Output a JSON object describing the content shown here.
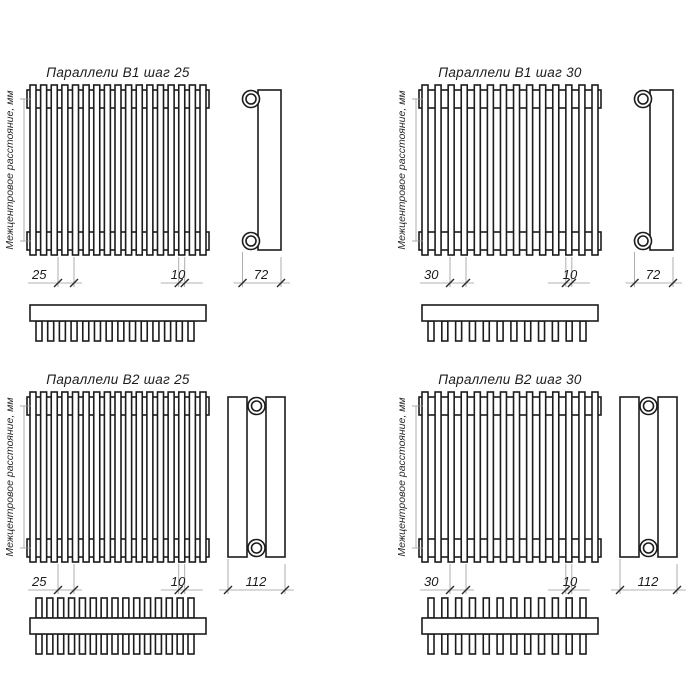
{
  "drawing": {
    "background": "#ffffff",
    "line_color": "#1c1c1c",
    "dim_line_color": "#9a9a9a",
    "axis_label": "Межцентровое расстояние, мм",
    "diagrams": [
      {
        "id": "b1-step25",
        "title": "Параллели В1 шаг 25",
        "variant": "B1",
        "front_tube_count": 17,
        "top_teeth_count": 14,
        "dim_step": "25",
        "dim_tube_width": "10",
        "dim_depth": "72"
      },
      {
        "id": "b1-step30",
        "title": "Параллели В1 шаг 30",
        "variant": "B1",
        "front_tube_count": 14,
        "top_teeth_count": 12,
        "dim_step": "30",
        "dim_tube_width": "10",
        "dim_depth": "72"
      },
      {
        "id": "b2-step25",
        "title": "Параллели В2 шаг 25",
        "variant": "B2",
        "front_tube_count": 17,
        "top_teeth_count": 15,
        "dim_step": "25",
        "dim_tube_width": "10",
        "dim_depth": "112"
      },
      {
        "id": "b2-step30",
        "title": "Параллели В2 шаг 30",
        "variant": "B2",
        "front_tube_count": 14,
        "top_teeth_count": 12,
        "dim_step": "30",
        "dim_tube_width": "10",
        "dim_depth": "112"
      }
    ]
  }
}
